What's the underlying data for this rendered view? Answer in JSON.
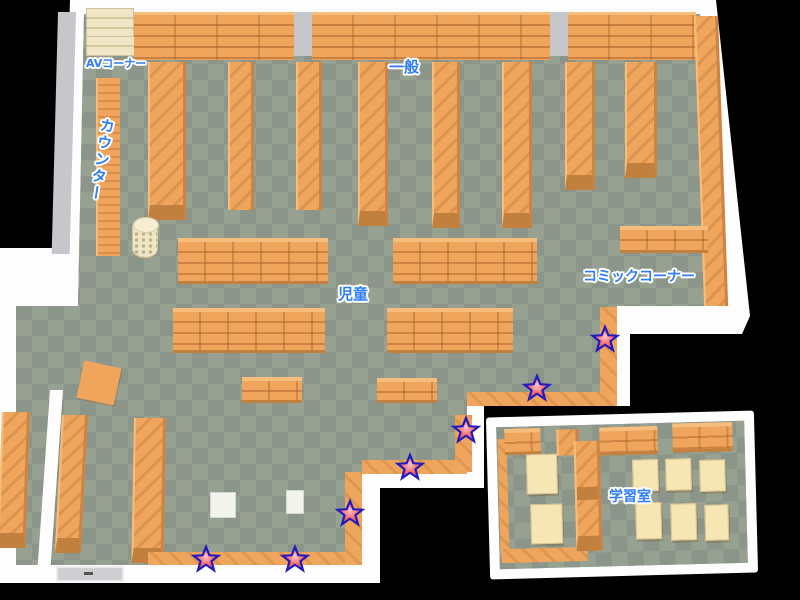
{
  "map": {
    "labels": {
      "av_corner": "AVコーナー",
      "counter": "カウンター",
      "general": "一般",
      "children": "児童",
      "comic_corner": "コミックコーナー",
      "study_room": "学習室"
    },
    "colors": {
      "floor_light": "#97a191",
      "floor_dark": "#8b9589",
      "shelf": "#efa55c",
      "shelf_light": "#f7bd7d",
      "shelf_dark": "#cd8443",
      "shelf_cap": "#c2803f",
      "wall": "#fdfdfd",
      "wall_side": "#c5c7cb",
      "av_shelf": "#f0e6c6",
      "table": "#f6e6b4",
      "label_blue": "#2f7df6",
      "star_red": "#e93b3b",
      "star_pink": "#ffc9c9",
      "star_outline": "#221bbf"
    },
    "stars": [
      {
        "x": 605,
        "y": 339
      },
      {
        "x": 537,
        "y": 388
      },
      {
        "x": 466,
        "y": 430
      },
      {
        "x": 410,
        "y": 467
      },
      {
        "x": 350,
        "y": 513
      },
      {
        "x": 295,
        "y": 559
      },
      {
        "x": 206,
        "y": 559
      }
    ]
  }
}
